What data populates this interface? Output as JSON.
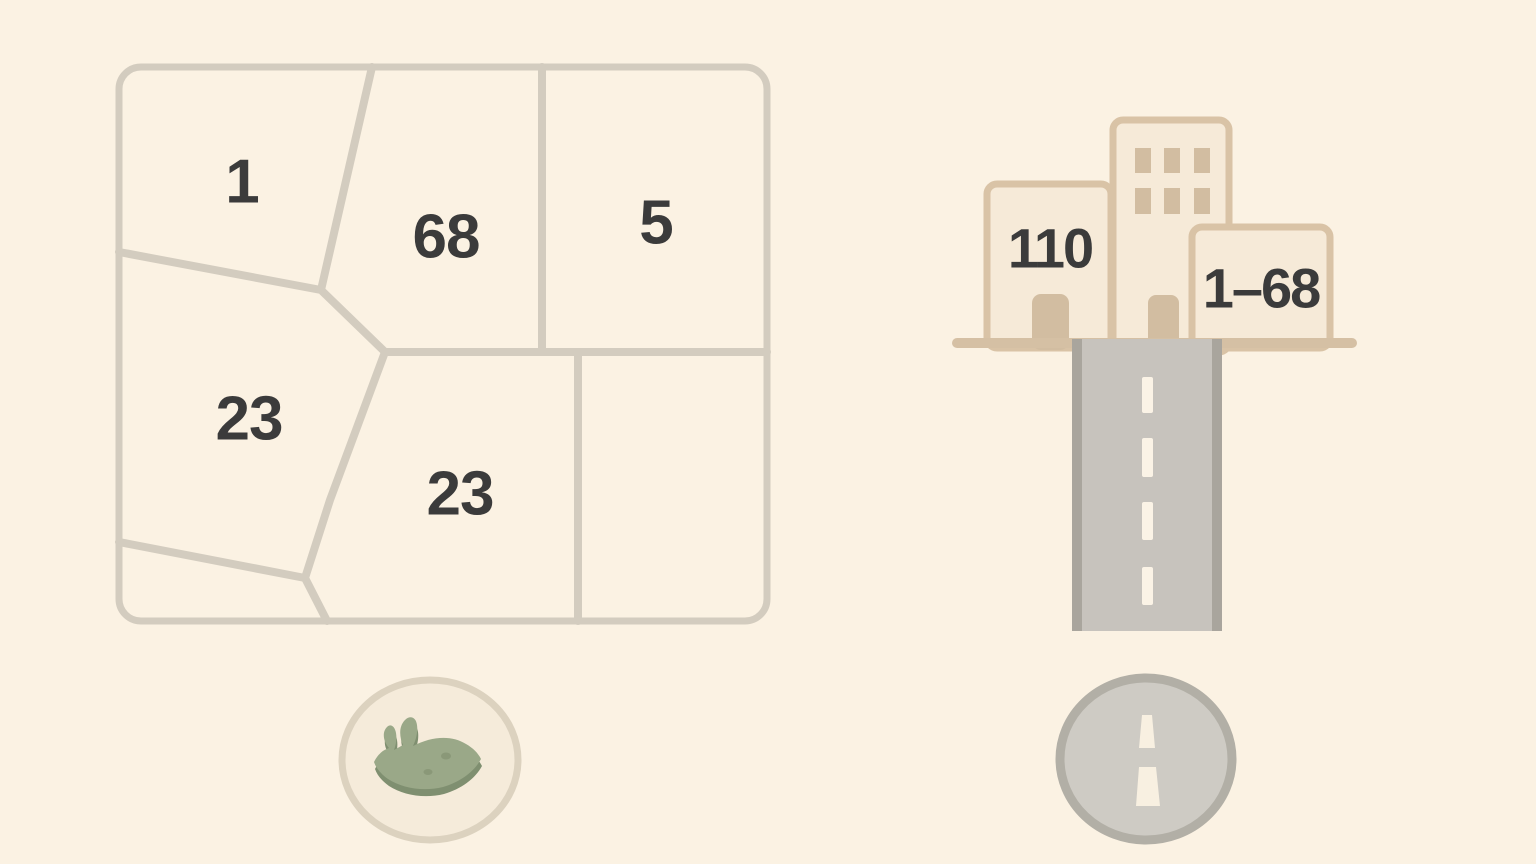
{
  "illustration": {
    "background_color": "#fbf2e3",
    "parcel_map": {
      "description": "land-parcel map with numbered plots",
      "line_color": "#d3ccbf",
      "label_color": "#3b3b3b",
      "parcels": [
        {
          "label": "1"
        },
        {
          "label": "68"
        },
        {
          "label": "5"
        },
        {
          "label": "23"
        },
        {
          "label": "23"
        }
      ]
    },
    "street_scene": {
      "description": "three buildings above a road",
      "left_building_number": "110",
      "right_building_range": "1–68",
      "building_fill": "#f6ead8",
      "building_border": "#d9c3a6",
      "trim_color": "#d2bda1",
      "ground_color": "#d5c0a4",
      "road_fill": "#c7c3bd",
      "road_edge": "#a9a59d",
      "road_dash": "#fbf3e6"
    },
    "badges": {
      "land_badge": {
        "icon": "grass-patch-icon",
        "fill": "#f5ebda",
        "border": "#dcd2bf",
        "grass_green": "#9aa888",
        "grass_green_dark": "#7f8f70"
      },
      "road_badge": {
        "icon": "road-icon",
        "fill": "#cecbc4",
        "border": "#b2afa6",
        "dash_color": "#f8f0e1"
      }
    }
  }
}
